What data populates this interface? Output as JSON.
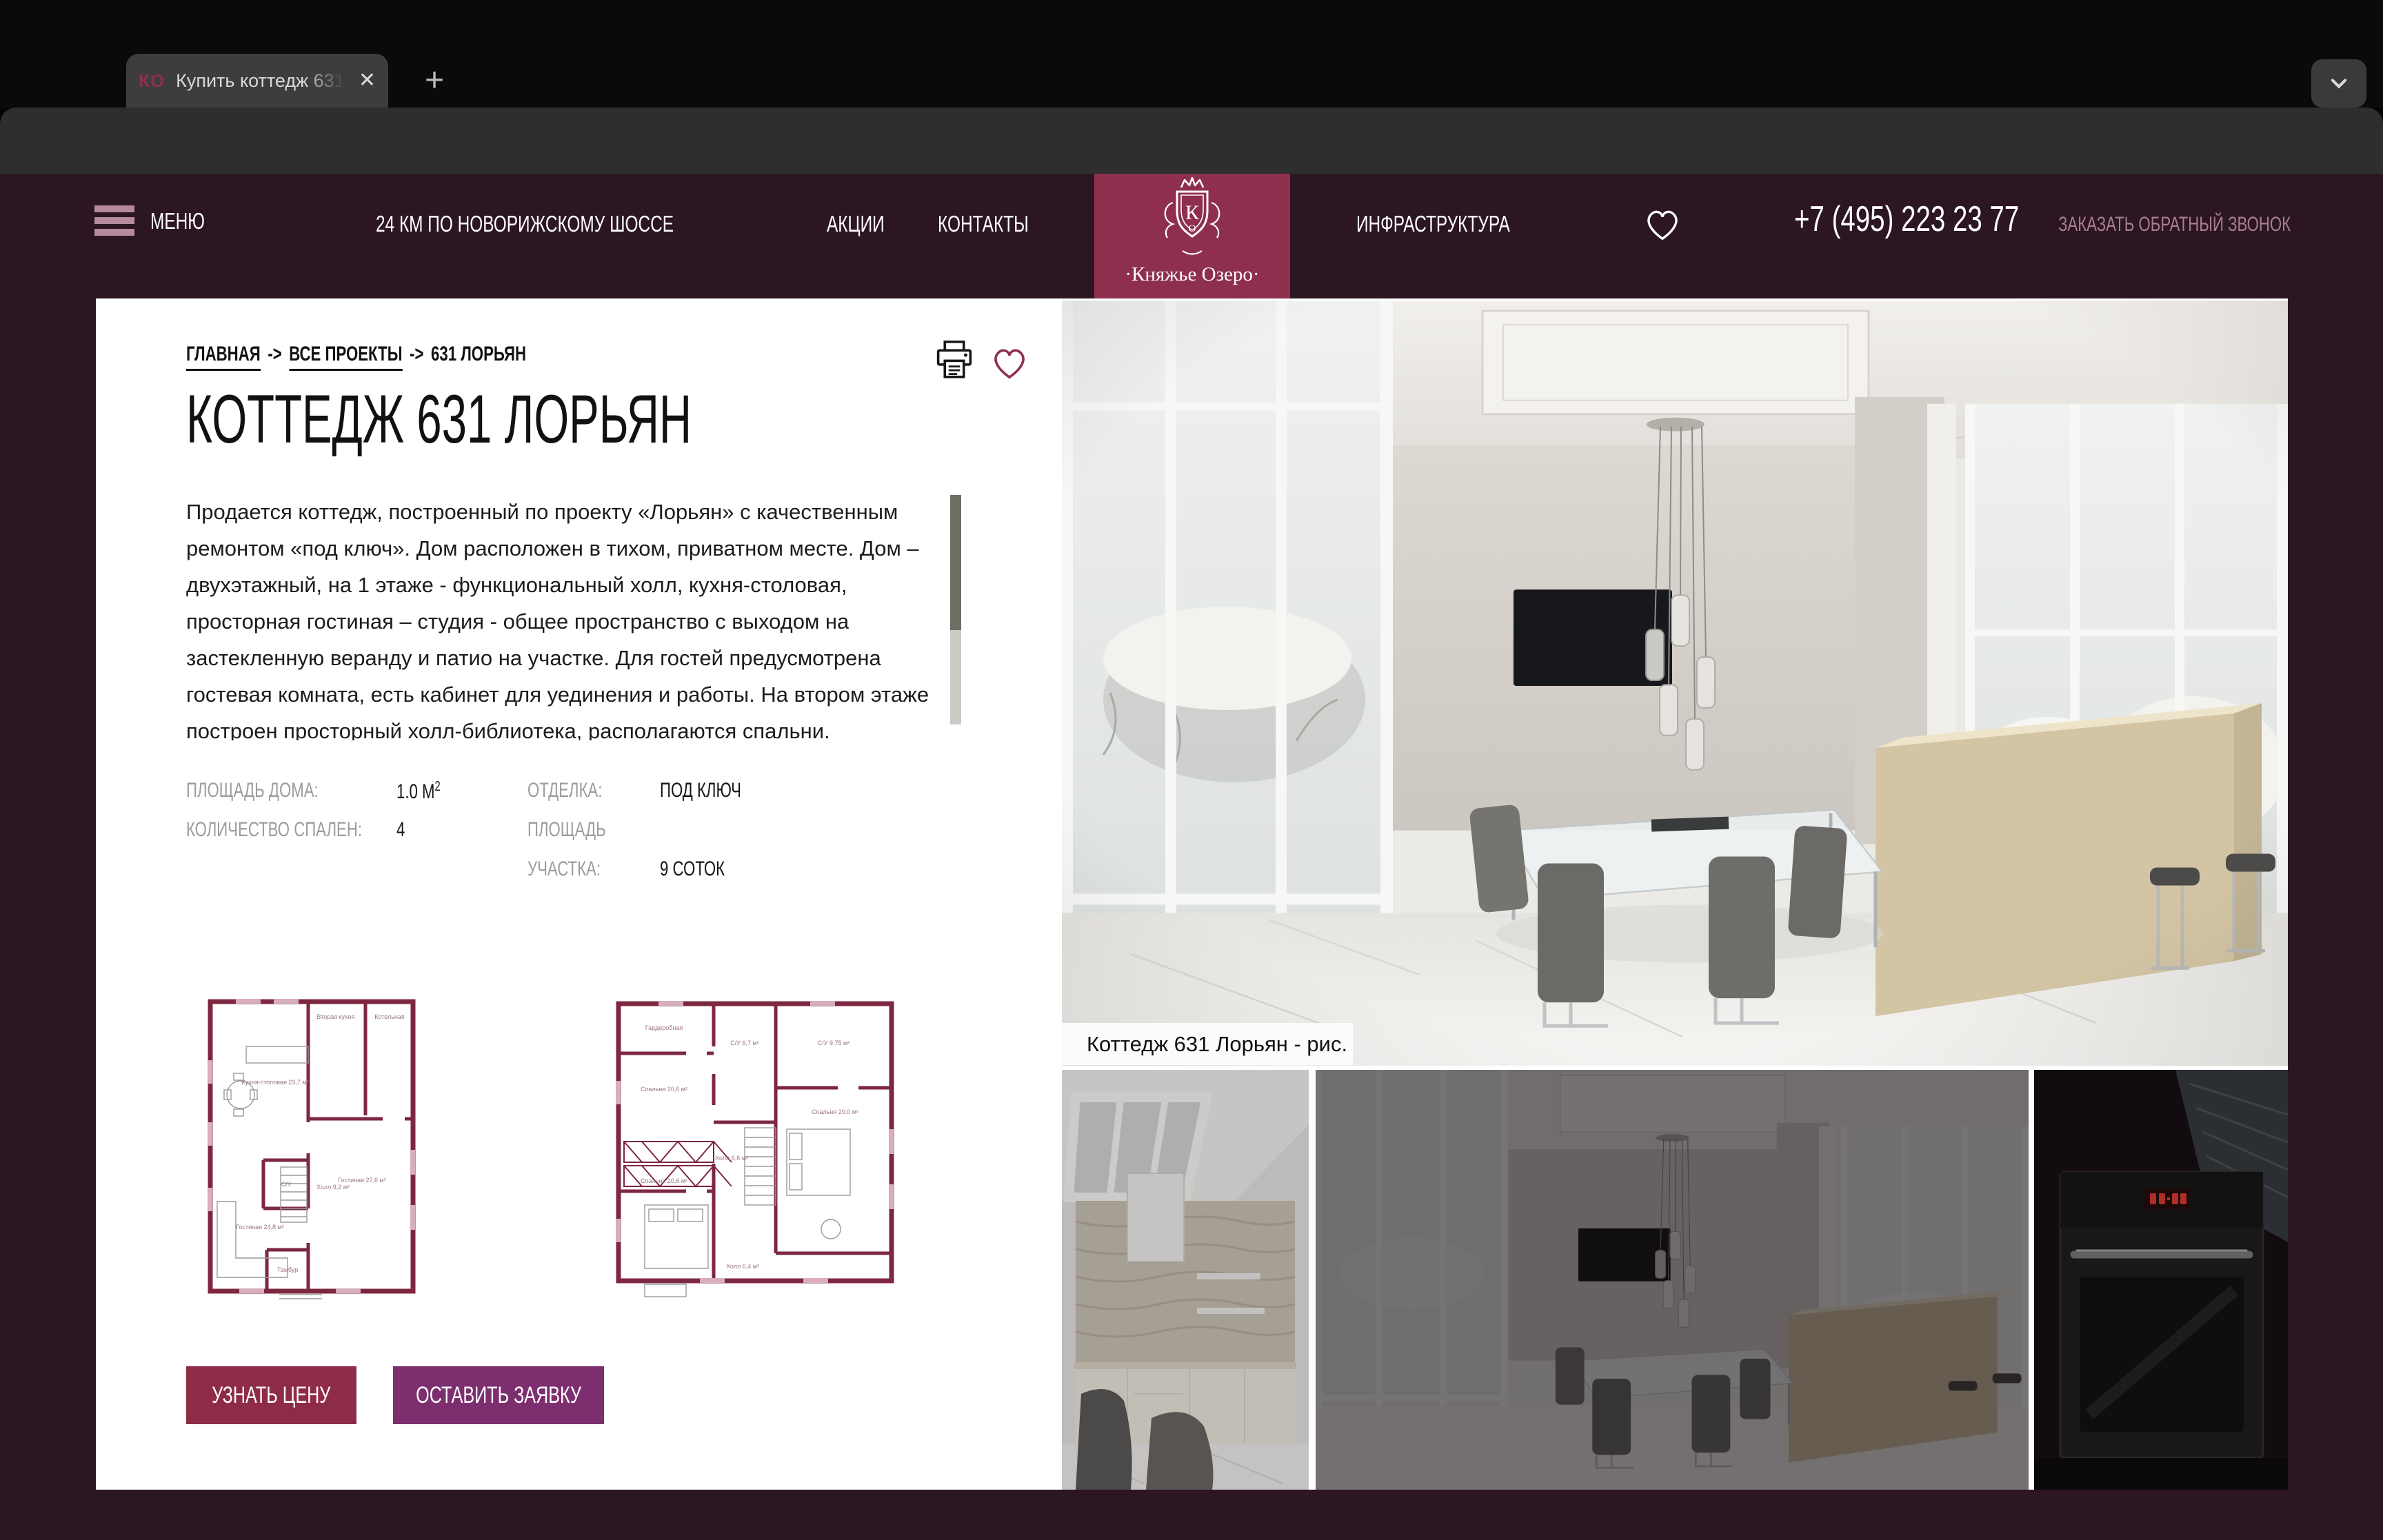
{
  "browser": {
    "tab_title": "Купить коттедж 631 Лорьян",
    "tab_favicon": "КО",
    "close_glyph": "✕",
    "new_tab_glyph": "+",
    "url": "https://www.kn-ozero.ru/projects/108/",
    "incognito_label": "Incognito (3)"
  },
  "header": {
    "menu_label": "МЕНЮ",
    "distance": "24 КМ ПО НОВОРИЖСКОМУ ШОССЕ",
    "nav_promo": "АКЦИИ",
    "nav_contacts": "КОНТАКТЫ",
    "nav_infrastructure": "ИНФРАСТРУКТУРА",
    "logo_monogram": "К",
    "logo_monogram_small": "О",
    "logo_name": "·Княжье Озеро·",
    "phone": "+7 (495) 223 23 77",
    "callback": "ЗАКАЗАТЬ ОБРАТНЫЙ ЗВОНОК"
  },
  "breadcrumb": {
    "home": "ГЛАВНАЯ",
    "sep": "->",
    "projects": "ВСЕ ПРОЕКТЫ",
    "current": "631 ЛОРЬЯН"
  },
  "listing": {
    "title": "КОТТЕДЖ 631 ЛОРЬЯН",
    "description": "Продается коттедж, построенный по проекту «Лорьян» с качественным ремонтом «под ключ». Дом расположен в тихом, приватном месте. Дом – двухэтажный, на 1 этаже - функциональный холл, кухня-столовая, просторная гостиная – студия - общее пространство с выходом на застекленную веранду и патио на участке. Для гостей предусмотрена гостевая комната, есть кабинет для уединения и работы. На втором этаже построен просторный холл-библиотека, располагаются спальни.",
    "specs": {
      "area_label": "ПЛОЩАДЬ ДОМА:",
      "area_value": "1.0 М",
      "area_sup": "2",
      "bedrooms_label": "КОЛИЧЕСТВО СПАЛЕН:",
      "bedrooms_value": "4",
      "finish_label": "ОТДЕЛКА:",
      "finish_value": "ПОД КЛЮЧ",
      "plot_label_1": "ПЛОЩАДЬ",
      "plot_label_2": "УЧАСТКА:",
      "plot_value": "9 СОТОК"
    },
    "btn_price": "УЗНАТЬ ЦЕНУ",
    "btn_request": "ОСТАВИТЬ ЗАЯВКУ",
    "photo_caption": "Коттедж 631 Лорьян - рис. 19",
    "plan1_rooms": [
      "Вторая кухня",
      "Котельная",
      "Кухня-столовая 23,7 м²",
      "С/У",
      "Холл 9,2 м²",
      "Гостиная 24,8 м²",
      "Гостиная 27,6 м²",
      "Тамбур"
    ],
    "plan2_rooms": [
      "Гардеробная",
      "С/У 6,7 м²",
      "С/У 9,75 м²",
      "Спальня 20,6 м²",
      "Спальня 20,0 м²",
      "Холл 6,6 м²",
      "Спальня 20,6 м²",
      "Холл 6,4 м²"
    ]
  },
  "colors": {
    "header_bg": "#2B1622",
    "logo_bg": "#8E2F4E",
    "btn_price_bg": "#8E2B47",
    "btn_request_bg": "#7C2E6F",
    "accent_pink": "#B58B9B",
    "callback_pink": "#A87F90"
  }
}
